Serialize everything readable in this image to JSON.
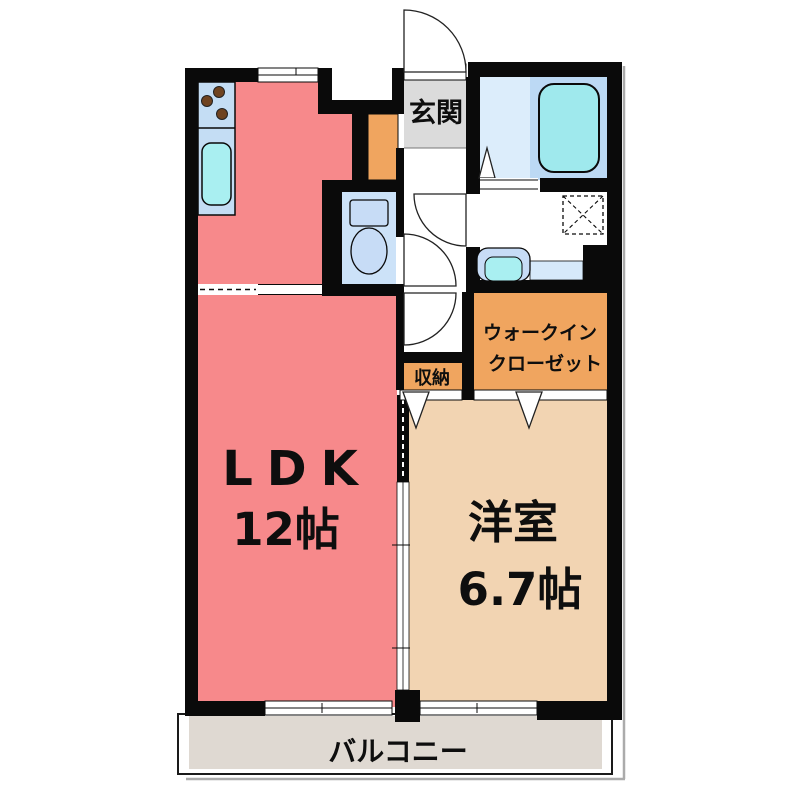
{
  "plan_title": "1LDK apartment floor plan",
  "rooms": {
    "ldk": {
      "label": "LDK",
      "size": "12帖"
    },
    "western": {
      "label": "洋室",
      "size": "6.7帖"
    },
    "entrance": {
      "label": "玄関"
    },
    "walk_in_closet": {
      "label_line1": "ウォークイン",
      "label_line2": "クローゼット"
    },
    "storage": {
      "label": "収納"
    },
    "balcony": {
      "label": "バルコニー"
    }
  },
  "colors": {
    "wall": "#0a0a0a",
    "ldk_pink": "#F7898B",
    "western_tan": "#F2D4B2",
    "closet_orange": "#F0A55F",
    "entrance_gray": "#DBDBDB",
    "balcony_gray": "#DFD9D2",
    "bath_floor_blue": "#DCEDFB",
    "tub_panel_blue": "#BCD9F4",
    "bathtub_cyan": "#9FE9ED",
    "toilet_floor_blue": "#CCE2F8",
    "fixture_blue": "#C7DCF6",
    "sink_cyan": "#A9EFF1",
    "kitchen_counter_blue": "#C4DDF4",
    "stove_dot_brown": "#6F4320"
  }
}
